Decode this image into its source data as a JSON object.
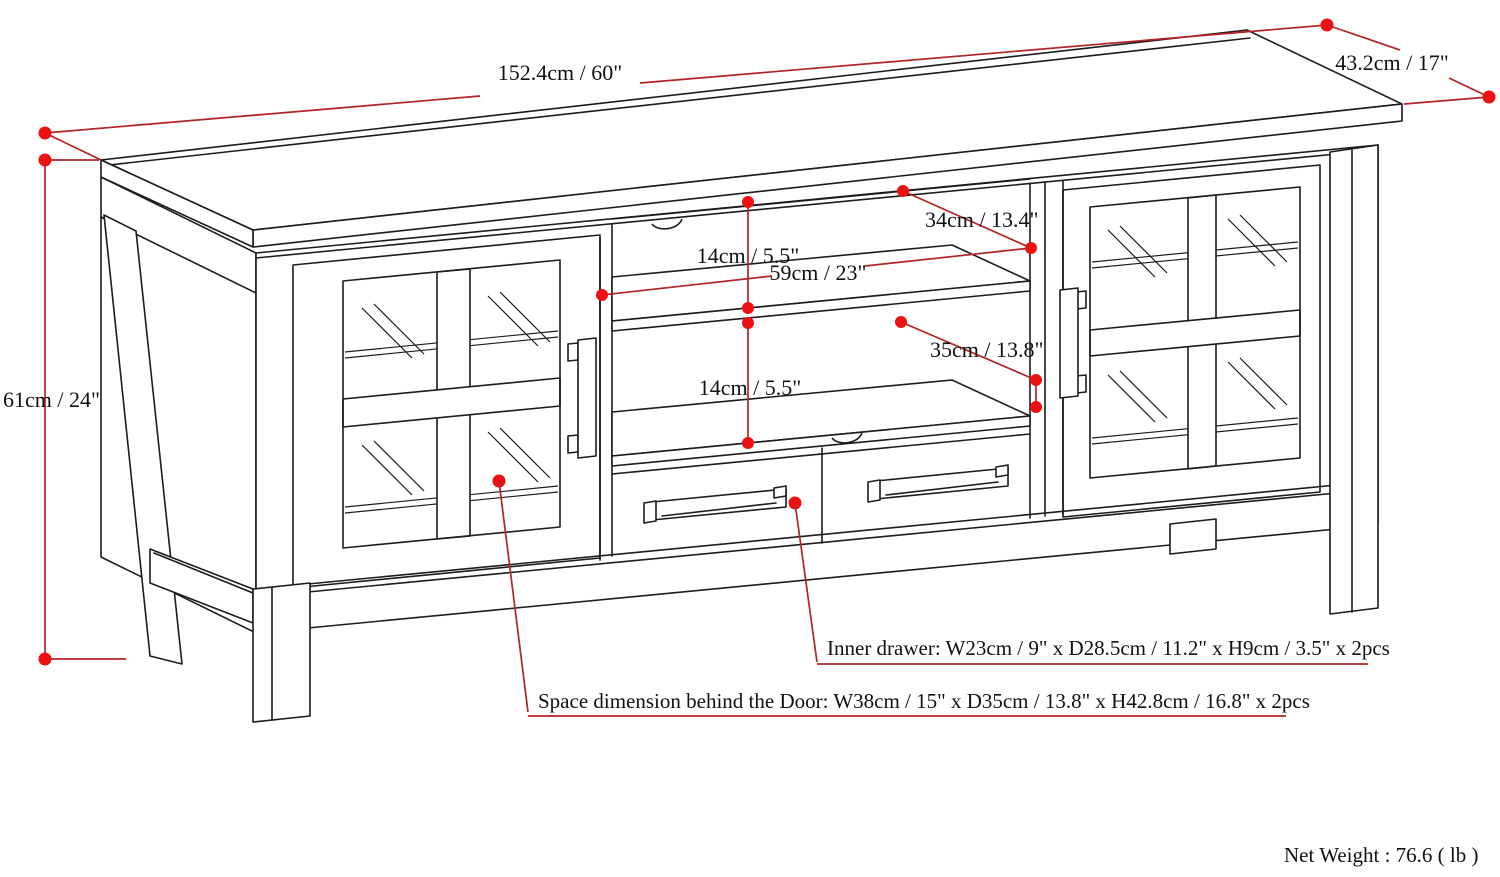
{
  "diagram": {
    "title": "TV stand dimension diagram",
    "dimensions": {
      "width": {
        "label": "152.4cm / 60\""
      },
      "depth": {
        "label": "43.2cm / 17\""
      },
      "height": {
        "label": "61cm / 24\""
      },
      "top_shelf_depth": {
        "label": "34cm / 13.4\""
      },
      "top_shelf_height": {
        "label": "14cm / 5.5\""
      },
      "middle_width": {
        "label": "59cm / 23\""
      },
      "bottom_shelf_depth": {
        "label": "35cm / 13.8\""
      },
      "bottom_shelf_height": {
        "label": "14cm / 5.5\""
      }
    },
    "notes": {
      "inner_drawer": "Inner drawer: W23cm / 9\" x D28.5cm / 11.2\" x H9cm / 3.5\" x 2pcs",
      "door_space": "Space dimension behind the Door: W38cm / 15\" x D35cm / 13.8\" x H42.8cm / 16.8\" x 2pcs",
      "net_weight": "Net Weight : 76.6 ( lb )"
    },
    "colors": {
      "dimension_line": "#b32424",
      "dimension_dot": "#ee1111",
      "drawing_line": "#1c1c1c"
    }
  }
}
